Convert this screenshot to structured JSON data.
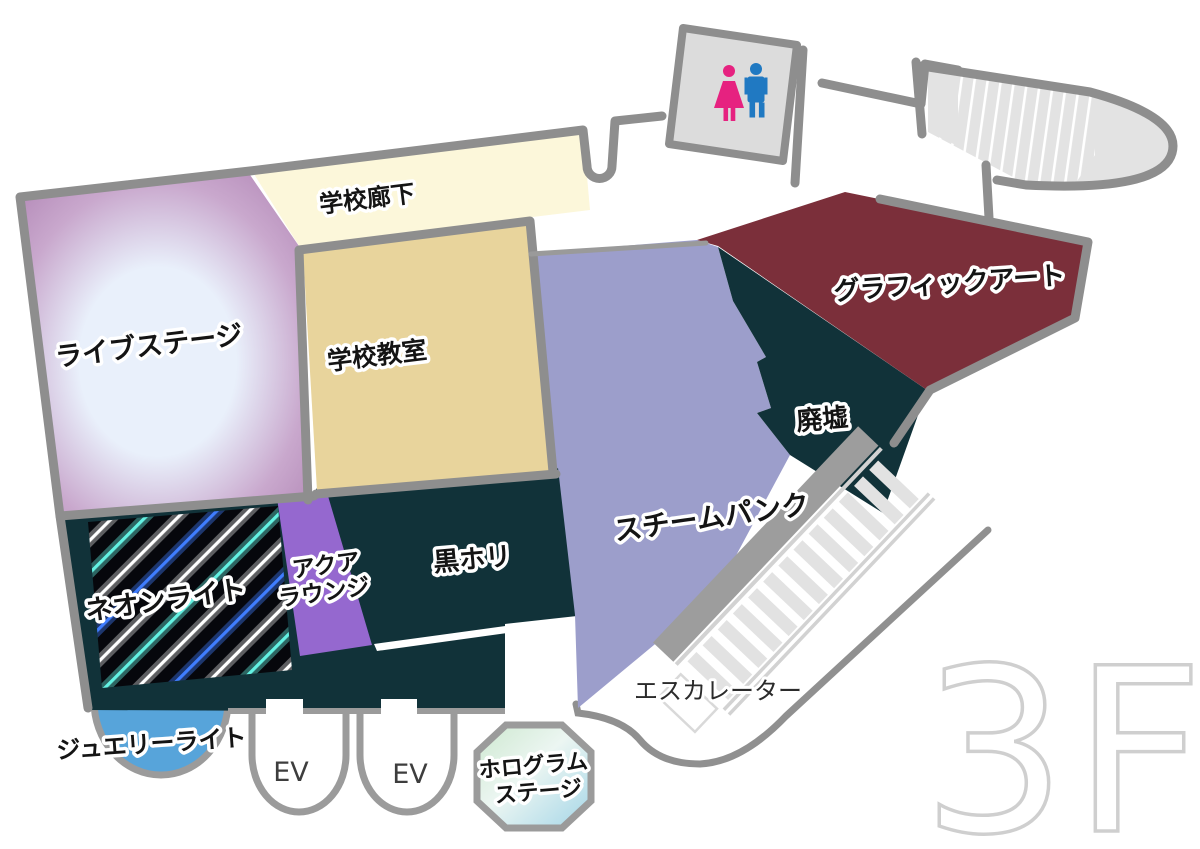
{
  "floor_label": "3F",
  "rooms": {
    "school_corridor": {
      "label": "学校廊下",
      "color": "#fcf7da"
    },
    "live_stage": {
      "label": "ライブステージ",
      "color_center": "#e9f0fb",
      "color_mid": "#c9a8cd",
      "color_edge": "#b186b5"
    },
    "school_classroom": {
      "label": "学校教室",
      "color": "#e8d49c"
    },
    "graphic_art": {
      "label": "グラフィックアート",
      "color": "#7b2f3a"
    },
    "ruins": {
      "label": "廃墟",
      "color": "#113239"
    },
    "steampunk": {
      "label": "スチームパンク",
      "color": "#9c9ecb"
    },
    "black_studio": {
      "label": "黒ホリ",
      "color": "#113239"
    },
    "neon_light": {
      "label": "ネオンライト",
      "base": "#06070c",
      "stripe_cyan": "#63f2e3",
      "stripe_white": "#ffffff",
      "stripe_blue": "#3f7dff"
    },
    "aqua_lounge": {
      "label_line1": "アクア",
      "label_line2": "ラウンジ",
      "color": "#9568cf"
    },
    "jewelry_light": {
      "label": "ジュエリーライト",
      "color": "#57a4da"
    },
    "hologram_stage": {
      "label_line1": "ホログラム",
      "label_line2": "ステージ",
      "color_green": "#cde8cf",
      "color_mid": "#ecf6f2",
      "color_blue": "#a3d5e7"
    },
    "escalator": {
      "label": "エスカレーター"
    },
    "stairs": {
      "name": "stairs"
    },
    "elevator_1": {
      "label": "EV"
    },
    "elevator_2": {
      "label": "EV"
    }
  },
  "restroom": {
    "floor_color": "#dcdcdc",
    "female_color": "#e62280",
    "male_color": "#2079c2"
  },
  "palette": {
    "wall": "#8e8e8e",
    "wall_light": "#9b9b9b",
    "dark_zone": "#113239",
    "stairs_fill": "#e3e3e3",
    "escalator_step": "#e2e2e2",
    "escalator_rail": "#d2d2d2",
    "escalator_balustrade": "#9d9d9d",
    "floor_label_color": "#cfcfcf"
  }
}
